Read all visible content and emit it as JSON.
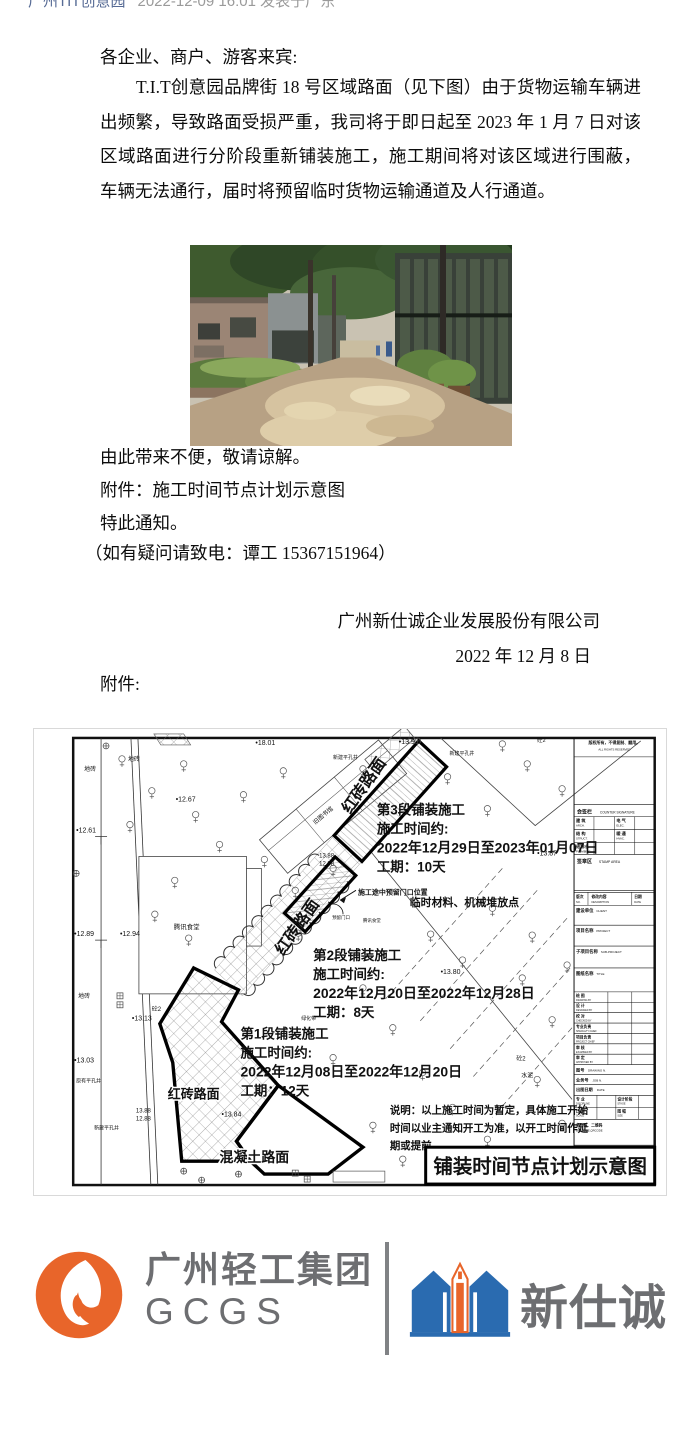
{
  "byline": {
    "account": "广州TIT创意园",
    "meta": "2022-12-09 16:01 发表于广东"
  },
  "notice": {
    "salutation": "各企业、商户、游客来宾:",
    "paragraph": "T.I.T创意园品牌街 18 号区域路面（见下图）由于货物运输车辆进出频繁，导致路面受损严重，我司将于即日起至 2023 年 1 月 7 日对该区域路面进行分阶段重新铺装施工，施工期间将对该区域进行围蔽，车辆无法通行，届时将预留临时货物运输通道及人行通道。",
    "line_apology": "由此带来不便，敬请谅解。",
    "line_attachment": "附件：施工时间节点计划示意图",
    "line_notice": "特此通知。",
    "line_contact": "（如有疑问请致电：谭工 15367151964）",
    "signature_company": "广州新仕诚企业发展股份有限公司",
    "signature_date": "2022 年 12 月 8 日",
    "attachment_label": "附件:"
  },
  "diagram": {
    "title": "铺装时间节点计划示意图",
    "phases": [
      {
        "name": "第3段铺装施工",
        "time_label": "施工时间约:",
        "dates": "2022年12月29日至2023年01月07日",
        "duration": "工期：10天",
        "x": 344,
        "y": 86
      },
      {
        "name": "第2段铺装施工",
        "time_label": "施工时间约:",
        "dates": "2022年12月20日至2022年12月28日",
        "duration": "工期：8天",
        "x": 280,
        "y": 232
      },
      {
        "name": "第1段铺装施工",
        "time_label": "施工时间约:",
        "dates": "2022年12月08日至2022年12月20日",
        "duration": "工期：12天",
        "x": 207,
        "y": 311
      }
    ],
    "notes": [
      "说明：以上施工时间为暂定，具体施工开始",
      "时间以业主通知开工为准，以开工时间作延",
      "期或提前。"
    ],
    "labels": [
      {
        "t": "•18.01",
        "x": 222,
        "y": 16,
        "s": 7
      },
      {
        "t": "地砖",
        "x": 50,
        "y": 42,
        "s": 6
      },
      {
        "t": "地砖",
        "x": 94,
        "y": 32,
        "s": 6
      },
      {
        "t": "地砖",
        "x": 44,
        "y": 270,
        "s": 6
      },
      {
        "t": "砼2",
        "x": 505,
        "y": 13,
        "s": 5.5
      },
      {
        "t": "•13.9",
        "x": 366,
        "y": 15,
        "s": 7
      },
      {
        "t": "新建平孔井",
        "x": 300,
        "y": 30,
        "s": 5
      },
      {
        "t": "新建平孔井",
        "x": 417,
        "y": 26,
        "s": 5
      },
      {
        "t": "•12.67",
        "x": 142,
        "y": 73,
        "s": 7
      },
      {
        "t": "•12.61",
        "x": 42,
        "y": 104,
        "s": 7
      },
      {
        "t": "旧图书馆",
        "x": 282,
        "y": 96,
        "s": 6,
        "r": -40
      },
      {
        "t": "•13.87",
        "x": 505,
        "y": 127,
        "s": 7
      },
      {
        "t": "红砖路面",
        "x": 317,
        "y": 86,
        "s": 16,
        "b": 1,
        "r": -55
      },
      {
        "t": "红砖路面",
        "x": 250,
        "y": 228,
        "s": 16,
        "b": 1,
        "r": -55
      },
      {
        "t": "13.88",
        "x": 286,
        "y": 129,
        "s": 6
      },
      {
        "t": "12.88",
        "x": 286,
        "y": 137,
        "s": 6
      },
      {
        "t": "•12.89",
        "x": 40,
        "y": 208,
        "s": 7
      },
      {
        "t": "•12.94",
        "x": 86,
        "y": 208,
        "s": 7
      },
      {
        "t": "腾讯食堂",
        "x": 140,
        "y": 201,
        "s": 6.5
      },
      {
        "t": "施工途中预留门口位置",
        "x": 325,
        "y": 166,
        "s": 7,
        "b": 1
      },
      {
        "t": "临时材料、机械堆放点",
        "x": 377,
        "y": 178,
        "s": 11,
        "b": 1
      },
      {
        "t": "预留门口",
        "x": 299,
        "y": 191,
        "s": 4.5
      },
      {
        "t": "腾讯食堂",
        "x": 330,
        "y": 194,
        "s": 4.5
      },
      {
        "t": "•13.80",
        "x": 408,
        "y": 246,
        "s": 7
      },
      {
        "t": "绿化带",
        "x": 268,
        "y": 292,
        "s": 5
      },
      {
        "t": "•13.13",
        "x": 98,
        "y": 293,
        "s": 7
      },
      {
        "t": "砼2",
        "x": 118,
        "y": 283,
        "s": 6
      },
      {
        "t": "•13.03",
        "x": 40,
        "y": 335,
        "s": 7
      },
      {
        "t": "原有平孔井",
        "x": 42,
        "y": 355,
        "s": 5
      },
      {
        "t": "红砖路面",
        "x": 134,
        "y": 371,
        "s": 13,
        "b": 1,
        "halo": 1
      },
      {
        "t": "13.88",
        "x": 102,
        "y": 385,
        "s": 6
      },
      {
        "t": "12.88",
        "x": 102,
        "y": 393,
        "s": 6
      },
      {
        "t": "新建平孔井",
        "x": 60,
        "y": 402,
        "s": 5
      },
      {
        "t": "•13.84",
        "x": 188,
        "y": 389,
        "s": 7
      },
      {
        "t": "混凝土路面",
        "x": 186,
        "y": 435,
        "s": 14,
        "b": 1,
        "halo": 1
      },
      {
        "t": "水泥",
        "x": 489,
        "y": 350,
        "s": 6
      },
      {
        "t": "砼2",
        "x": 484,
        "y": 333,
        "s": 6
      }
    ],
    "trees": [
      [
        88,
        30
      ],
      [
        150,
        35
      ],
      [
        118,
        62
      ],
      [
        162,
        86
      ],
      [
        96,
        96
      ],
      [
        210,
        66
      ],
      [
        250,
        42
      ],
      [
        186,
        116
      ],
      [
        231,
        131
      ],
      [
        141,
        152
      ],
      [
        262,
        162
      ],
      [
        121,
        186
      ],
      [
        155,
        210
      ],
      [
        330,
        40
      ],
      [
        415,
        48
      ],
      [
        455,
        80
      ],
      [
        470,
        15
      ],
      [
        495,
        35
      ],
      [
        530,
        60
      ],
      [
        300,
        140
      ],
      [
        265,
        205
      ],
      [
        330,
        260
      ],
      [
        360,
        300
      ],
      [
        300,
        330
      ],
      [
        390,
        345
      ],
      [
        420,
        380
      ],
      [
        455,
        412
      ],
      [
        340,
        398
      ],
      [
        370,
        432
      ],
      [
        490,
        250
      ],
      [
        520,
        292
      ],
      [
        460,
        180
      ],
      [
        500,
        207
      ],
      [
        535,
        237
      ],
      [
        505,
        352
      ],
      [
        530,
        396
      ],
      [
        480,
        432
      ],
      [
        430,
        232
      ],
      [
        398,
        206
      ]
    ],
    "plus_symbols": [
      [
        150,
        444
      ],
      [
        168,
        453
      ],
      [
        205,
        447
      ],
      [
        72,
        17
      ],
      [
        42,
        145
      ],
      [
        385,
        12
      ]
    ],
    "square_symbols": [
      [
        86,
        268
      ],
      [
        86,
        277
      ],
      [
        262,
        446
      ],
      [
        274,
        452
      ]
    ],
    "titleblock": {
      "copyright_cn": "版权所有，不得复制、翻用。",
      "copyright_en": "ALL RIGHTS RESERVED",
      "countersign_cn": "会签栏",
      "countersign_en": "COUNTER SIGNATURE",
      "disciplines": [
        [
          "建 筑",
          "ARCH."
        ],
        [
          "电 气",
          "ELEC."
        ],
        [
          "结 构",
          "STRUCT."
        ],
        [
          "暖 通",
          "HVAC."
        ],
        [
          "给排水",
          "PLUMBING"
        ]
      ],
      "stamp_cn": "签章区",
      "stamp_en": "STAMP AREA",
      "revision": [
        [
          "版次",
          "NO."
        ],
        [
          "修改内容",
          "DESCRIPTION"
        ],
        [
          "日期",
          "DATE"
        ]
      ],
      "info": [
        [
          "建设单位",
          "CLIENT"
        ],
        [
          "项目名称",
          "PROJECT"
        ],
        [
          "子项目名称",
          "SUB-PROJECT"
        ],
        [
          "图纸名称",
          "TITLE"
        ]
      ],
      "signoff": [
        [
          "绘 图",
          "DRAWING BY"
        ],
        [
          "设 计",
          "DESIGNED BY"
        ],
        [
          "校 对",
          "CHECKED BY"
        ],
        [
          "专业负责",
          "SPECIALTY CHIEF"
        ],
        [
          "项目负责",
          "PROJECT CHIEF"
        ],
        [
          "审 核",
          "EXAMINED BY"
        ],
        [
          "审 定",
          "APPROVED BY"
        ]
      ],
      "numbers": [
        [
          "图号",
          "DRAWING N."
        ],
        [
          "业务号",
          "JOB N."
        ],
        [
          "出图日期",
          "DATE"
        ]
      ],
      "meta": [
        [
          "专 业",
          "DISCIPLINE"
        ],
        [
          "设计阶段",
          "STAGE"
        ],
        [
          "比 例",
          "SCALE"
        ],
        [
          "图 幅",
          "SIZE"
        ]
      ],
      "barcode_cn": "条形码、二维码",
      "barcode_en": "BARCODE,QRCODE"
    }
  },
  "footer": {
    "gcgs_name": "广州轻工集团",
    "gcgs_abbr": "GCGS",
    "xsc_name": "新仕诚",
    "orange": "#e8652a",
    "blue": "#2a6bb0",
    "gray": "#6d6e71"
  }
}
